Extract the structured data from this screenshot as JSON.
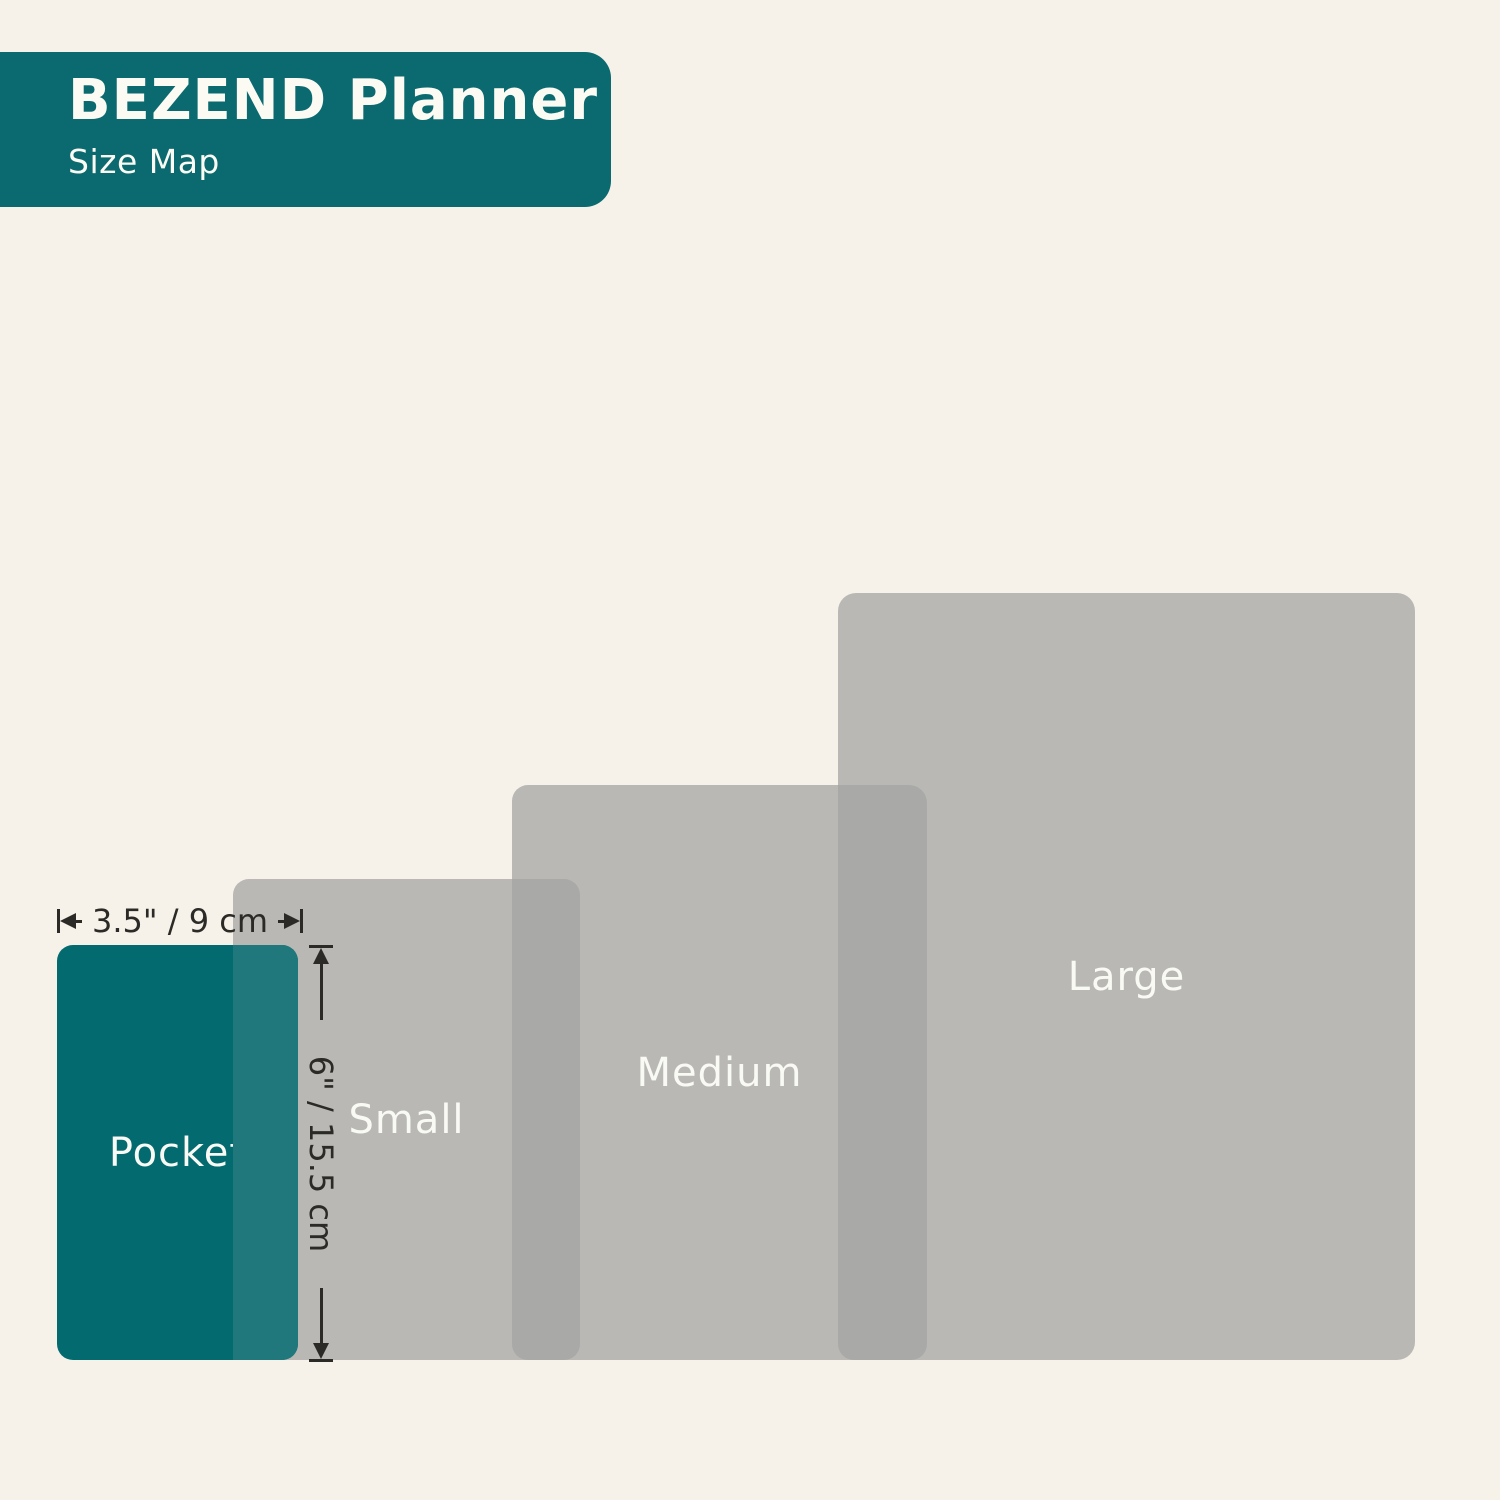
{
  "header": {
    "title": "BEZEND Planner",
    "subtitle": "Size Map"
  },
  "sizes": [
    {
      "id": "pocket",
      "label": "Pocket"
    },
    {
      "id": "small",
      "label": "Small"
    },
    {
      "id": "medium",
      "label": "Medium"
    },
    {
      "id": "large",
      "label": "Large"
    }
  ],
  "dimensions": {
    "width_label": "3.5\" / 9 cm",
    "height_label": "6\" / 15.5 cm"
  },
  "colors": {
    "background": "#f6f2e9",
    "teal": "#0b6a6f",
    "pocket_teal": "#036b70",
    "teal_overlap": "#20787c",
    "gray": "#b9b8b5",
    "gray_overlap": "#a9a9a7",
    "ink": "#2b2a26",
    "label_text": "#fafaf5"
  }
}
